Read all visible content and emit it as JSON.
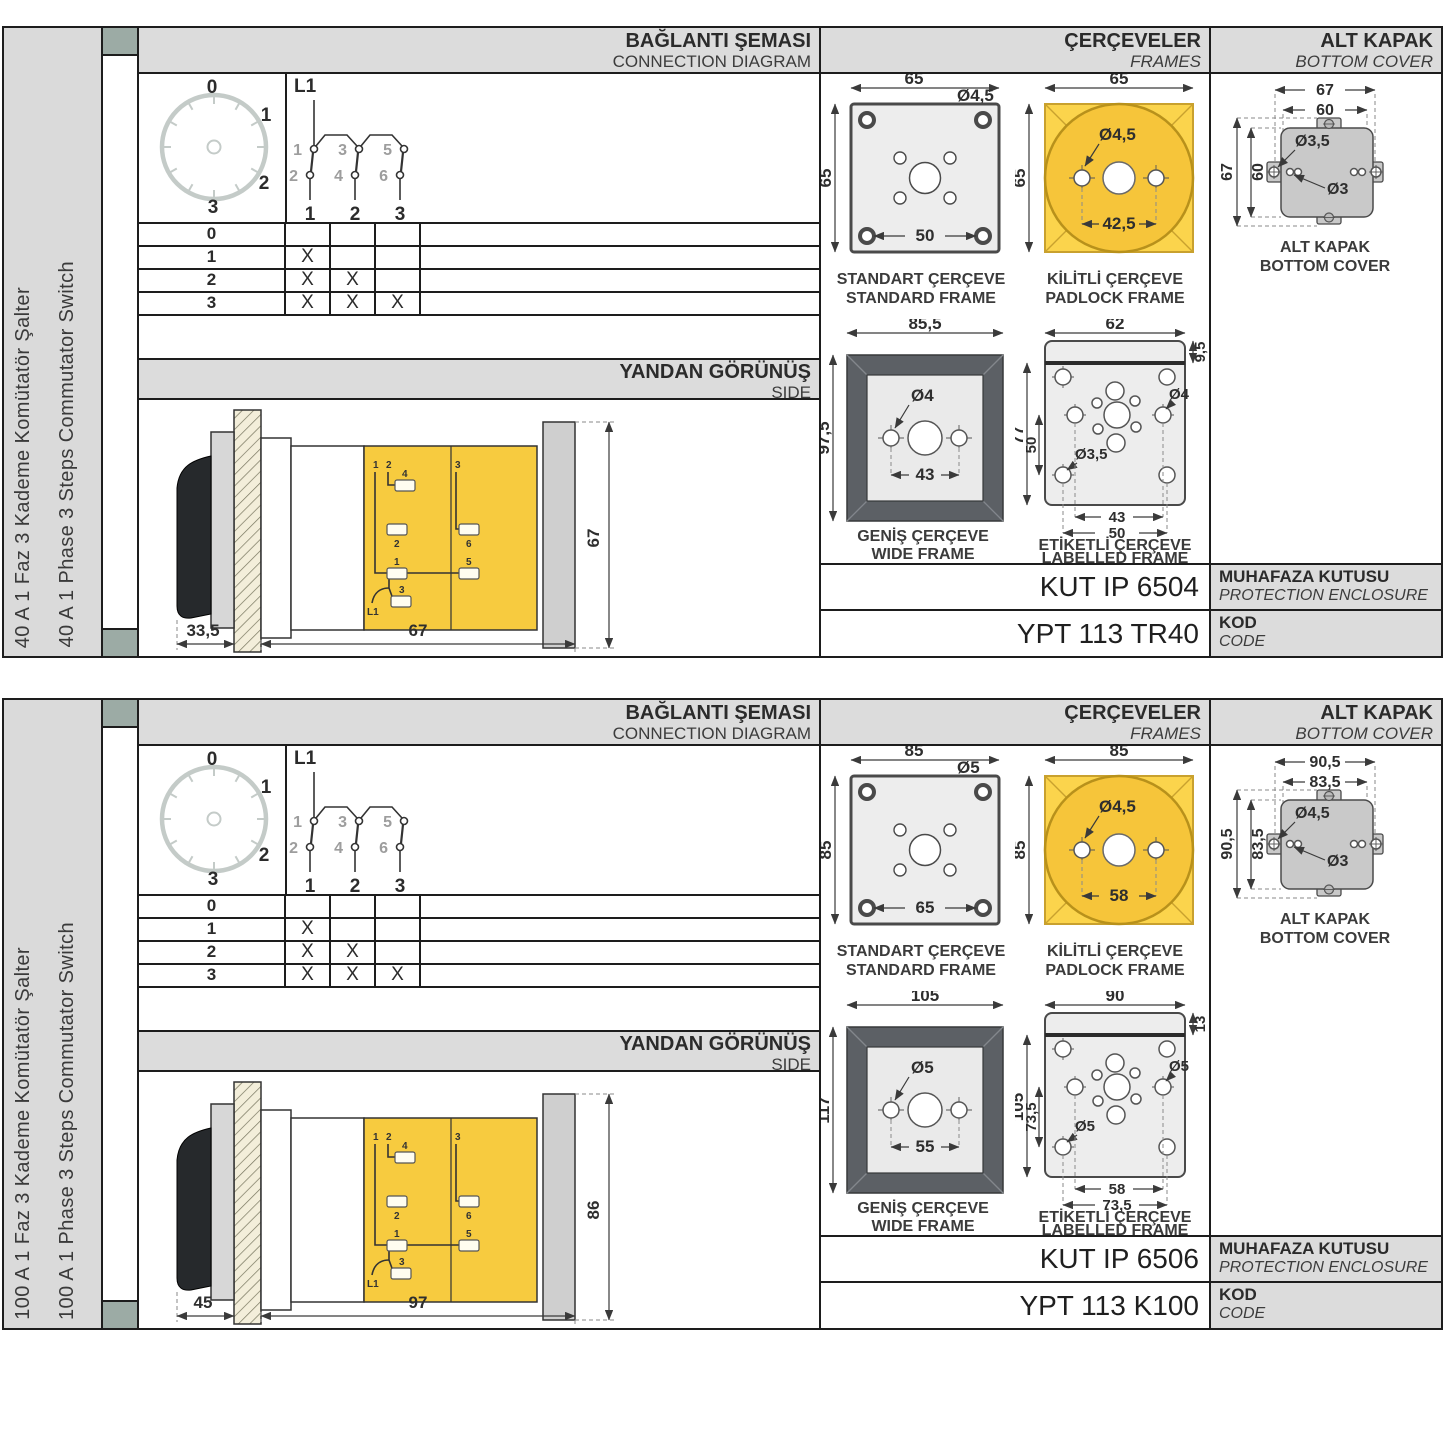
{
  "colors": {
    "accent_yellow": "#F6C53A",
    "panel_gray": "#DCDCDC",
    "sage_marker": "#9CABA5",
    "frame_dark_gray": "#5C6065"
  },
  "sections": [
    {
      "side_label_tr": "40 A 1 Faz 3 Kademe Komütatör Şalter",
      "side_label_en": "40 A 1 Phase 3 Steps Commutator Switch",
      "headers": {
        "diagram_tr": "BAĞLANTI ŞEMASI",
        "diagram_en": "CONNECTION DIAGRAM",
        "frames_tr": "ÇERÇEVELER",
        "frames_en": "FRAMES",
        "cover_tr": "ALT KAPAK",
        "cover_en": "BOTTOM COVER"
      },
      "dial": {
        "positions": [
          "0",
          "1",
          "2",
          "3"
        ]
      },
      "circuit": {
        "feed": "L1",
        "top_contacts": [
          "1",
          "3",
          "5"
        ],
        "bottom_contacts": [
          "2",
          "4",
          "6"
        ],
        "outputs": [
          "1",
          "2",
          "3"
        ]
      },
      "table": {
        "rows": [
          {
            "label": "0",
            "marks": [
              "",
              "",
              ""
            ]
          },
          {
            "label": "1",
            "marks": [
              "X",
              "",
              ""
            ]
          },
          {
            "label": "2",
            "marks": [
              "X",
              "X",
              ""
            ]
          },
          {
            "label": "3",
            "marks": [
              "X",
              "X",
              "X"
            ]
          }
        ]
      },
      "side_view": {
        "title_tr": "YANDAN GÖRÜNÜŞ",
        "title_en": "SIDE",
        "dim_front": "33,5",
        "dim_length": "67",
        "dim_height": "67",
        "terminals": {
          "tl1": "1",
          "tl2": "2",
          "t4": "4",
          "t2": "2",
          "t1": "1",
          "t3": "3",
          "l1": "L1",
          "r3": "3",
          "t6": "6",
          "t5": "5"
        }
      },
      "frames": {
        "standard": {
          "caption_tr": "STANDART ÇERÇEVE",
          "caption_en": "STANDARD FRAME",
          "dim_w": "65",
          "dim_h": "65",
          "dim_holes": "50",
          "dia": "Ø4,5"
        },
        "padlock": {
          "caption_tr": "KİLİTLİ ÇERÇEVE",
          "caption_en": "PADLOCK FRAME",
          "dim_w": "65",
          "dim_h": "65",
          "dim_holes": "42,5",
          "dia": "Ø4,5"
        },
        "wide": {
          "caption_tr": "GENİŞ ÇERÇEVE",
          "caption_en": "WIDE FRAME",
          "dim_w": "85,5",
          "dim_h": "97,5",
          "dim_holes": "43",
          "dia": "Ø4"
        },
        "labelled": {
          "caption_tr": "ETİKETLİ ÇERÇEVE",
          "caption_en": "LABELLED FRAME",
          "dim_w": "62",
          "dim_strip": "9,5",
          "dim_h": "77",
          "dim_h_inner": "50",
          "dia_right": "Ø4",
          "dia_left": "Ø3,5",
          "dim_holes_inner": "43",
          "dim_holes_outer": "50"
        }
      },
      "bottom_cover": {
        "caption_tr": "ALT KAPAK",
        "caption_en": "BOTTOM COVER",
        "dim_w_outer": "67",
        "dim_w_inner": "60",
        "dim_h_outer": "67",
        "dim_h_inner": "60",
        "dia_big": "Ø3,5",
        "dia_small": "Ø3"
      },
      "enclosure": {
        "code": "KUT IP 6504",
        "label_tr": "MUHAFAZA KUTUSU",
        "label_en": "PROTECTION ENCLOSURE"
      },
      "product": {
        "code": "YPT 113 TR40",
        "label_tr": "KOD",
        "label_en": "CODE"
      }
    },
    {
      "side_label_tr": "100 A 1 Faz 3 Kademe Komütatör Şalter",
      "side_label_en": "100 A 1 Phase 3 Steps Commutator Switch",
      "headers": {
        "diagram_tr": "BAĞLANTI ŞEMASI",
        "diagram_en": "CONNECTION DIAGRAM",
        "frames_tr": "ÇERÇEVELER",
        "frames_en": "FRAMES",
        "cover_tr": "ALT KAPAK",
        "cover_en": "BOTTOM COVER"
      },
      "dial": {
        "positions": [
          "0",
          "1",
          "2",
          "3"
        ]
      },
      "circuit": {
        "feed": "L1",
        "top_contacts": [
          "1",
          "3",
          "5"
        ],
        "bottom_contacts": [
          "2",
          "4",
          "6"
        ],
        "outputs": [
          "1",
          "2",
          "3"
        ]
      },
      "table": {
        "rows": [
          {
            "label": "0",
            "marks": [
              "",
              "",
              ""
            ]
          },
          {
            "label": "1",
            "marks": [
              "X",
              "",
              ""
            ]
          },
          {
            "label": "2",
            "marks": [
              "X",
              "X",
              ""
            ]
          },
          {
            "label": "3",
            "marks": [
              "X",
              "X",
              "X"
            ]
          }
        ]
      },
      "side_view": {
        "title_tr": "YANDAN GÖRÜNÜŞ",
        "title_en": "SIDE",
        "dim_front": "45",
        "dim_length": "97",
        "dim_height": "86",
        "terminals": {
          "tl1": "1",
          "tl2": "2",
          "t4": "4",
          "t2": "2",
          "t1": "1",
          "t3": "3",
          "l1": "L1",
          "r3": "3",
          "t6": "6",
          "t5": "5"
        }
      },
      "frames": {
        "standard": {
          "caption_tr": "STANDART ÇERÇEVE",
          "caption_en": "STANDARD FRAME",
          "dim_w": "85",
          "dim_h": "85",
          "dim_holes": "65",
          "dia": "Ø5"
        },
        "padlock": {
          "caption_tr": "KİLİTLİ ÇERÇEVE",
          "caption_en": "PADLOCK FRAME",
          "dim_w": "85",
          "dim_h": "85",
          "dim_holes": "58",
          "dia": "Ø4,5"
        },
        "wide": {
          "caption_tr": "GENİŞ ÇERÇEVE",
          "caption_en": "WIDE FRAME",
          "dim_w": "105",
          "dim_h": "117",
          "dim_holes": "55",
          "dia": "Ø5"
        },
        "labelled": {
          "caption_tr": "ETİKETLİ ÇERÇEVE",
          "caption_en": "LABELLED FRAME",
          "dim_w": "90",
          "dim_strip": "13",
          "dim_h": "105",
          "dim_h_inner": "73,5",
          "dia_right": "Ø5",
          "dia_left": "Ø5",
          "dim_holes_inner": "58",
          "dim_holes_outer": "73,5"
        }
      },
      "bottom_cover": {
        "caption_tr": "ALT KAPAK",
        "caption_en": "BOTTOM COVER",
        "dim_w_outer": "90,5",
        "dim_w_inner": "83,5",
        "dim_h_outer": "90,5",
        "dim_h_inner": "83,5",
        "dia_big": "Ø4,5",
        "dia_small": "Ø3"
      },
      "enclosure": {
        "code": "KUT IP 6506",
        "label_tr": "MUHAFAZA KUTUSU",
        "label_en": "PROTECTION ENCLOSURE"
      },
      "product": {
        "code": "YPT 113 K100",
        "label_tr": "KOD",
        "label_en": "CODE"
      }
    }
  ]
}
